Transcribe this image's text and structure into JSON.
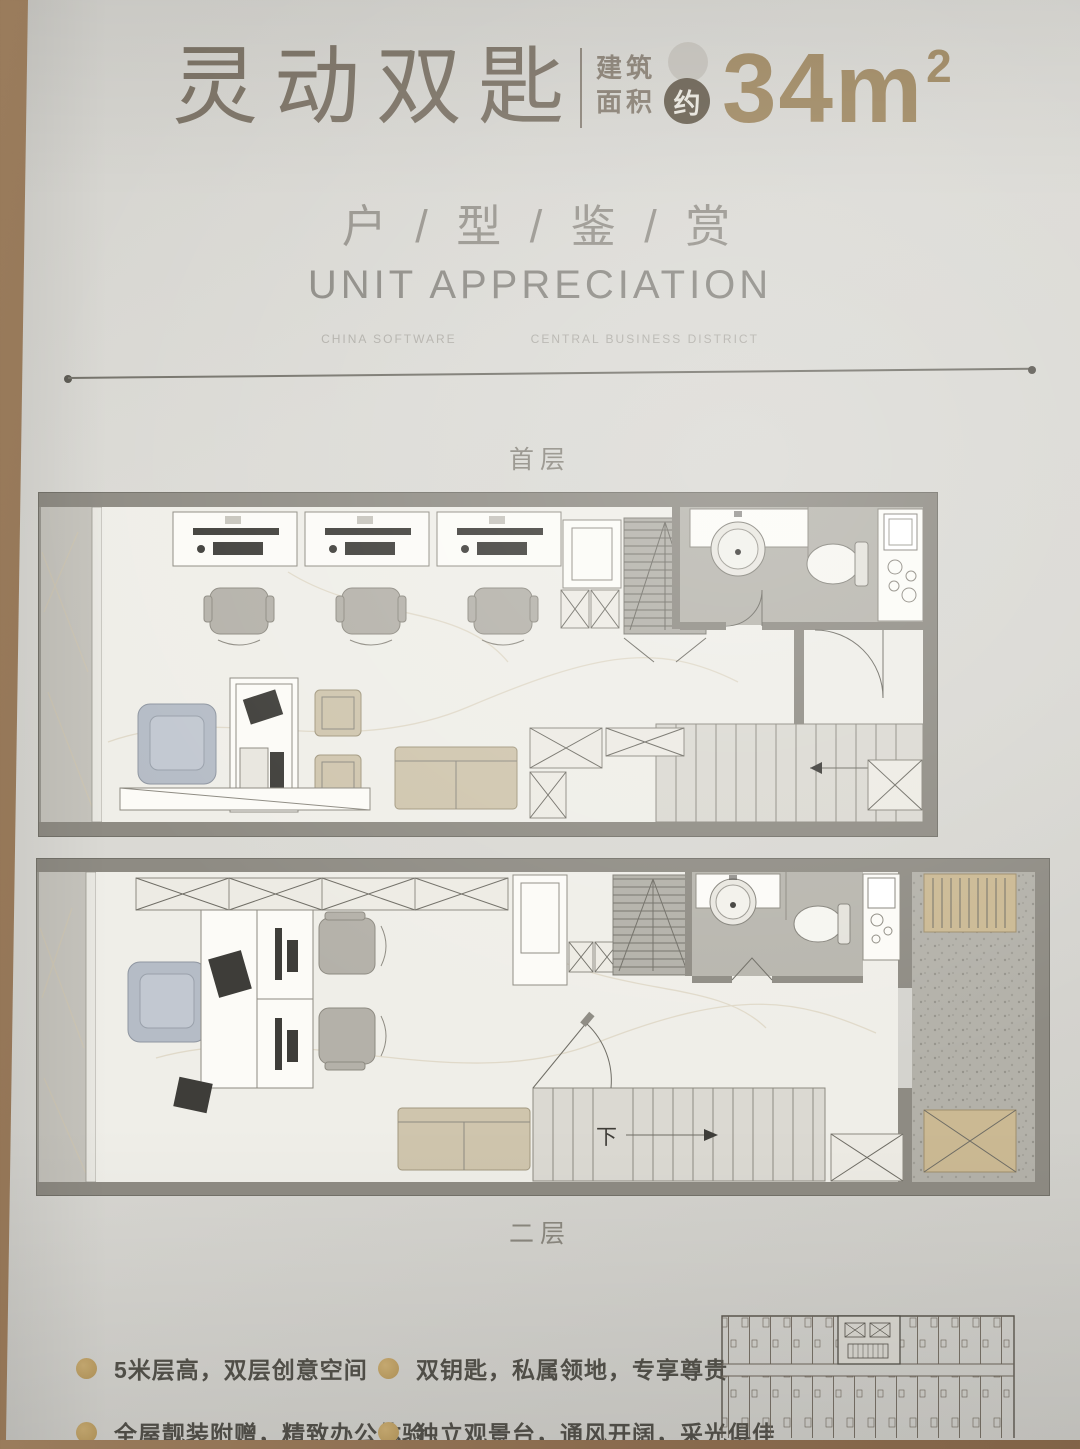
{
  "header": {
    "title": "灵动双匙",
    "area": {
      "prefix_line1": "建筑",
      "prefix_line2": "面积",
      "approx_badge": "约",
      "value": "34m",
      "superscript": "2"
    }
  },
  "subtitle": {
    "cn": "户 / 型 / 鉴 / 赏",
    "en": "UNIT APPRECIATION",
    "tagline_left": "CHINA SOFTWARE",
    "tagline_right": "CENTRAL BUSINESS DISTRICT"
  },
  "plans": {
    "floor1_label": "首层",
    "floor2_label": "二层",
    "stair_down_label": "下"
  },
  "features": {
    "items": [
      {
        "text": "5米层高，双层创意空间"
      },
      {
        "text": "双钥匙，私属领地，专享尊贵"
      },
      {
        "text": "全屋靓装附赠，精致办公体验"
      },
      {
        "text": "独立观景台，通风开阔，采光俱佳"
      }
    ]
  },
  "colors": {
    "accent_tan": "#a18a63",
    "title_taupe": "#7e7568",
    "badge_dark": "#6b6253",
    "wall_gray": "#8e8b83",
    "bath_floor": "#b7b5ad",
    "bullet_gold": "#c2a368",
    "page_bg": "#d8d7d2",
    "wood_bg": "#8a6b4e"
  }
}
